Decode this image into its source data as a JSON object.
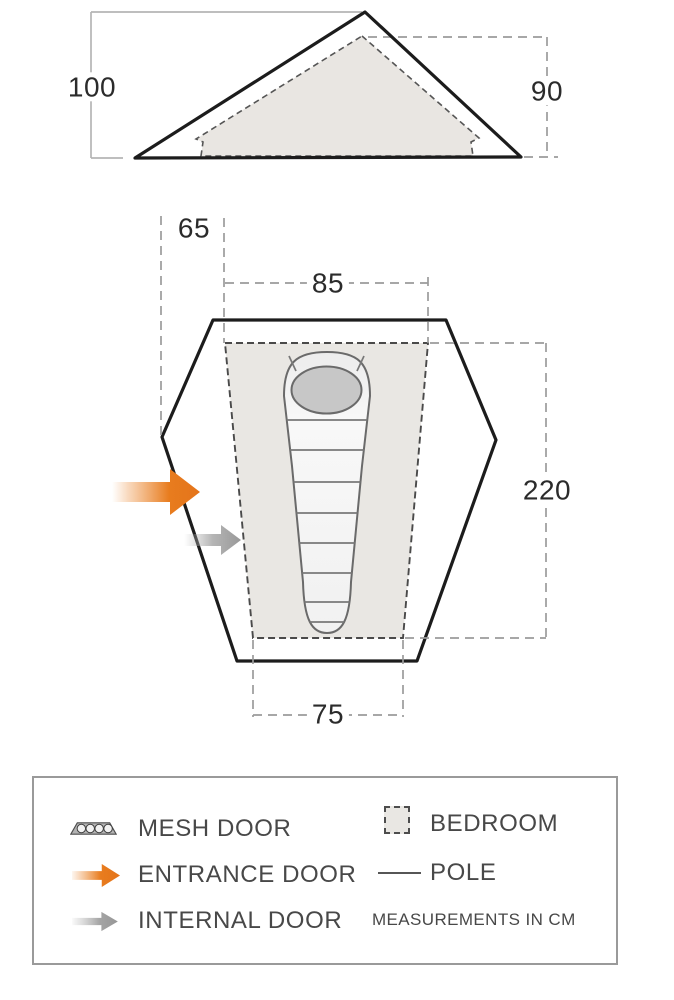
{
  "measurements": {
    "outer_height": "100",
    "inner_height": "90",
    "porch_depth": "65",
    "bedroom_width_head": "85",
    "bedroom_length": "220",
    "bedroom_width_foot": "75"
  },
  "legend": {
    "left_items": [
      {
        "icon": "mesh-door-icon",
        "label": "MESH DOOR"
      },
      {
        "icon": "entrance-door-icon",
        "label": "ENTRANCE DOOR"
      },
      {
        "icon": "internal-door-icon",
        "label": "INTERNAL DOOR"
      }
    ],
    "right_items": [
      {
        "icon": "bedroom-icon",
        "label": "BEDROOM"
      },
      {
        "icon": "pole-icon",
        "label": "POLE"
      }
    ],
    "note": "MEASUREMENTS IN CM"
  },
  "colors": {
    "entrance_orange": "#e87c1e",
    "internal_gray": "#9e9e9e",
    "bedroom_fill": "#e9e7e3",
    "tent_outline": "#1c1c1c",
    "measure_line_gray": "#9b9b9b",
    "text": "#484848"
  }
}
